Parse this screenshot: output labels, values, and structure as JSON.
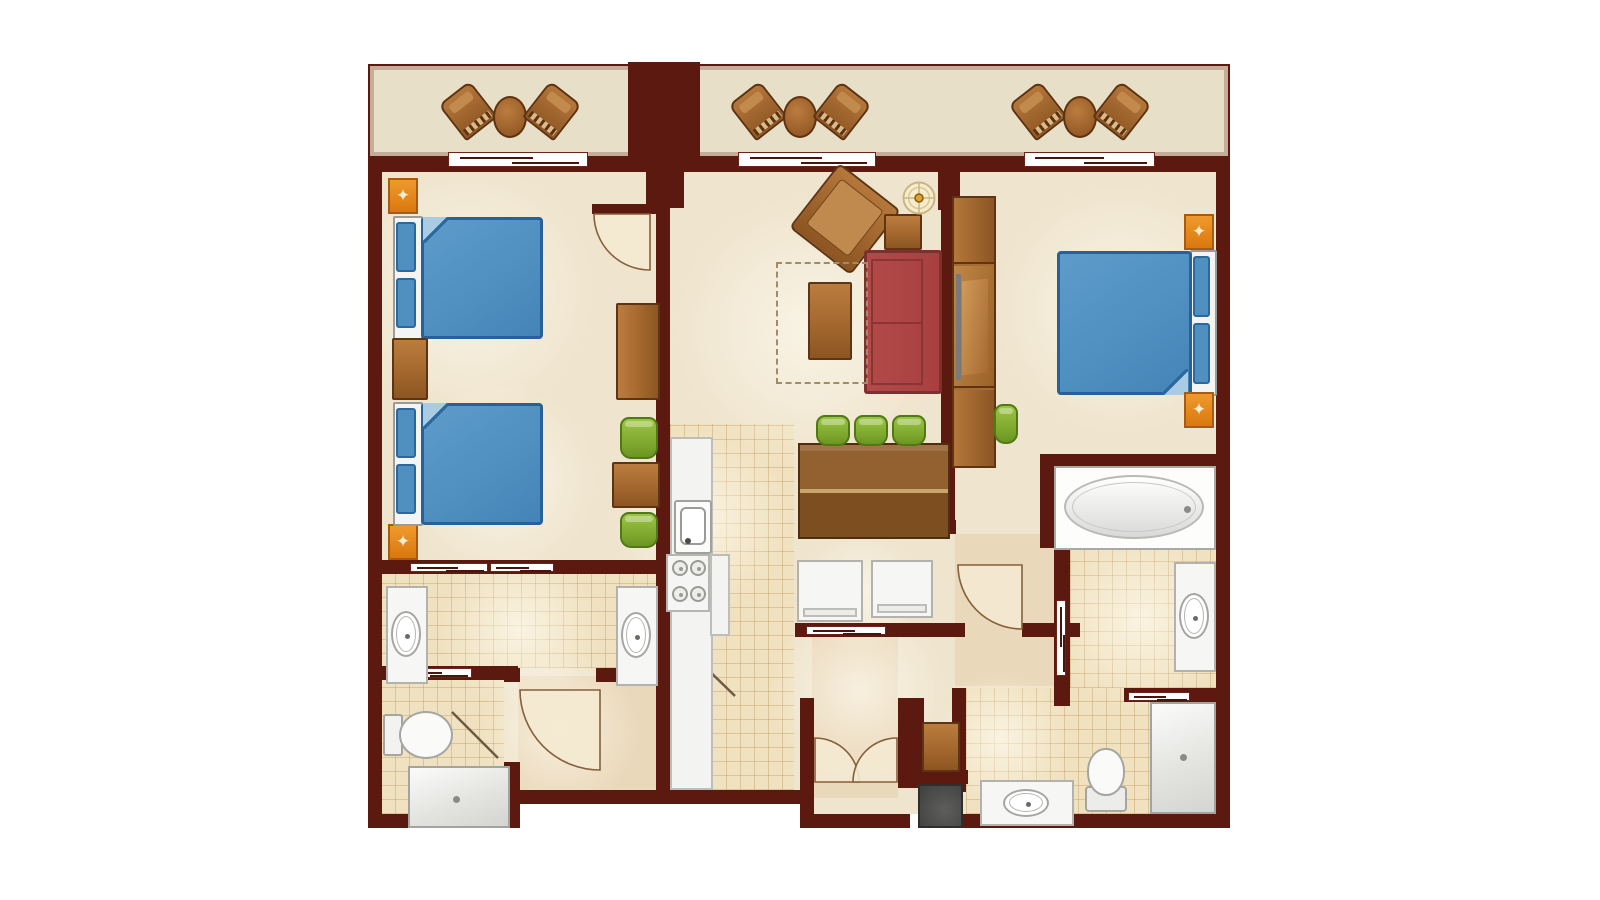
{
  "meta": {
    "description": "Two-bedroom villa resort floor plan, top-down view, no text labels",
    "canvas": {
      "w": 1600,
      "h": 900,
      "background": "#ffffff"
    }
  },
  "palette": {
    "wall": "#5b190f",
    "floor": "#efe4cd",
    "floor_tan": "#ead8ba",
    "tile": "#f0e2c1",
    "balcony": "#e8dfc9",
    "wood": "#a4682e",
    "wood_dark_border": "#5e3514",
    "green_chair": "#7ba62c",
    "sofa_red": "#b04848",
    "sofa_border": "#7e2f2f",
    "bed_blue": "#4f90c1",
    "bed_border": "#276198",
    "fixture_white": "#f6f6f4",
    "orange": "#e5861c",
    "utility_gray": "#4e4e4c",
    "arc_stroke": "#85603a",
    "arc_fill": "#f4ead2"
  },
  "floors": [
    {
      "k": "balcony",
      "n": "balcony-floor",
      "x": 368,
      "y": 64,
      "w": 862,
      "h": 94
    },
    {
      "k": "cream",
      "n": "main-floor-upper",
      "x": 381,
      "y": 172,
      "w": 835,
      "h": 390
    },
    {
      "k": "cream",
      "n": "main-floor-left",
      "x": 381,
      "y": 562,
      "w": 276,
      "h": 252
    },
    {
      "k": "cream",
      "n": "main-floor-kitchen",
      "x": 657,
      "y": 562,
      "w": 141,
      "h": 228
    },
    {
      "k": "cream",
      "n": "main-floor-right",
      "x": 795,
      "y": 562,
      "w": 421,
      "h": 252
    },
    {
      "k": "tan",
      "n": "closet-floor",
      "x": 518,
      "y": 676,
      "w": 138,
      "h": 116
    },
    {
      "k": "tan",
      "n": "entry-hall-floor",
      "x": 812,
      "y": 637,
      "w": 86,
      "h": 161
    },
    {
      "k": "tan",
      "n": "bedroom2-hall-floor",
      "x": 955,
      "y": 534,
      "w": 99,
      "h": 152
    },
    {
      "k": "tile",
      "n": "vanity-room-tile",
      "x": 381,
      "y": 574,
      "w": 275,
      "h": 94
    },
    {
      "k": "tile",
      "n": "toilet-room-tile",
      "x": 381,
      "y": 680,
      "w": 123,
      "h": 134
    },
    {
      "k": "tile",
      "n": "kitchen-tile",
      "x": 670,
      "y": 424,
      "w": 124,
      "h": 366
    },
    {
      "k": "tile",
      "n": "bath2-upper-tile",
      "x": 1070,
      "y": 548,
      "w": 146,
      "h": 140
    },
    {
      "k": "tile",
      "n": "bath2-lower-tile",
      "x": 966,
      "y": 688,
      "w": 250,
      "h": 126
    },
    {
      "k": "white",
      "n": "plan-cutout",
      "x": 518,
      "y": 804,
      "w": 288,
      "h": 26
    }
  ],
  "glows": [
    [
      470,
      290,
      130
    ],
    [
      500,
      480,
      100
    ],
    [
      810,
      330,
      140
    ],
    [
      700,
      520,
      90
    ],
    [
      860,
      690,
      90
    ],
    [
      1120,
      310,
      130
    ],
    [
      1140,
      620,
      90
    ],
    [
      520,
      630,
      80
    ],
    [
      560,
      730,
      80
    ],
    [
      860,
      590,
      60
    ],
    [
      1000,
      740,
      70
    ]
  ],
  "walls": [
    {
      "n": "wall-top",
      "x": 368,
      "y": 156,
      "w": 862,
      "h": 16
    },
    {
      "n": "wall-left",
      "x": 368,
      "y": 156,
      "w": 14,
      "h": 672
    },
    {
      "n": "wall-right",
      "x": 1216,
      "y": 156,
      "w": 14,
      "h": 672
    },
    {
      "n": "wall-bottom-left",
      "x": 368,
      "y": 814,
      "w": 152,
      "h": 14
    },
    {
      "n": "wall-step",
      "x": 504,
      "y": 762,
      "w": 16,
      "h": 66
    },
    {
      "n": "wall-bottom-mid",
      "x": 504,
      "y": 790,
      "w": 302,
      "h": 14
    },
    {
      "n": "wall-entry-left",
      "x": 800,
      "y": 698,
      "w": 14,
      "h": 130
    },
    {
      "n": "wall-entry-right",
      "x": 898,
      "y": 698,
      "w": 14,
      "h": 90
    },
    {
      "n": "wall-entry-bottom",
      "x": 806,
      "y": 814,
      "w": 104,
      "h": 14
    },
    {
      "n": "wall-utility-top",
      "x": 908,
      "y": 770,
      "w": 60,
      "h": 14
    },
    {
      "n": "wall-utility-left",
      "x": 908,
      "y": 698,
      "w": 16,
      "h": 90
    },
    {
      "n": "wall-bath2-divider",
      "x": 952,
      "y": 688,
      "w": 14,
      "h": 104
    },
    {
      "n": "wall-bottom-right",
      "x": 952,
      "y": 814,
      "w": 278,
      "h": 14
    },
    {
      "n": "wall-bed1-block",
      "x": 646,
      "y": 166,
      "w": 38,
      "h": 42
    },
    {
      "n": "wall-bed1-vertical",
      "x": 656,
      "y": 196,
      "w": 14,
      "h": 594
    },
    {
      "n": "wall-bed1-door",
      "x": 592,
      "y": 204,
      "w": 72,
      "h": 10
    },
    {
      "n": "wall-bed1-bottom",
      "x": 368,
      "y": 560,
      "w": 300,
      "h": 14
    },
    {
      "n": "wall-living-block",
      "x": 938,
      "y": 166,
      "w": 22,
      "h": 44
    },
    {
      "n": "wall-living-vertical",
      "x": 941,
      "y": 196,
      "w": 14,
      "h": 338
    },
    {
      "n": "wall-hall-h",
      "x": 912,
      "y": 520,
      "w": 44,
      "h": 14
    },
    {
      "n": "wall-laundry",
      "x": 795,
      "y": 623,
      "w": 170,
      "h": 14
    },
    {
      "n": "wall-bed2-bottom",
      "x": 1040,
      "y": 454,
      "w": 190,
      "h": 14
    },
    {
      "n": "wall-tub-left",
      "x": 1040,
      "y": 454,
      "w": 14,
      "h": 94
    },
    {
      "n": "wall-hall2-h",
      "x": 1022,
      "y": 623,
      "w": 58,
      "h": 14
    },
    {
      "n": "wall-hall2-v",
      "x": 1054,
      "y": 548,
      "w": 16,
      "h": 158
    },
    {
      "n": "wall-shower-top",
      "x": 1124,
      "y": 688,
      "w": 106,
      "h": 14
    },
    {
      "n": "wall-closet-top-a",
      "x": 504,
      "y": 668,
      "w": 16,
      "h": 14
    },
    {
      "n": "wall-closet-top-b",
      "x": 596,
      "y": 668,
      "w": 62,
      "h": 14
    },
    {
      "n": "wall-toilet-top",
      "x": 368,
      "y": 666,
      "w": 150,
      "h": 14
    },
    {
      "n": "balcony-column",
      "x": 628,
      "y": 62,
      "w": 72,
      "h": 96
    }
  ],
  "sliders": [
    {
      "n": "balcony-slider-1",
      "x": 448,
      "y": 152,
      "w": 140,
      "h": 15,
      "o": "h"
    },
    {
      "n": "balcony-slider-2",
      "x": 738,
      "y": 152,
      "w": 138,
      "h": 15,
      "o": "h"
    },
    {
      "n": "balcony-slider-3",
      "x": 1024,
      "y": 152,
      "w": 131,
      "h": 15,
      "o": "h"
    },
    {
      "n": "vanity-pocket-door-1",
      "x": 410,
      "y": 563,
      "w": 78,
      "h": 9,
      "o": "h"
    },
    {
      "n": "vanity-pocket-door-2",
      "x": 490,
      "y": 563,
      "w": 64,
      "h": 9,
      "o": "h"
    },
    {
      "n": "toilet-pocket-door",
      "x": 394,
      "y": 668,
      "w": 78,
      "h": 10,
      "o": "h"
    },
    {
      "n": "hall-pocket-door",
      "x": 806,
      "y": 626,
      "w": 80,
      "h": 9,
      "o": "h"
    },
    {
      "n": "bath2-pocket-door",
      "x": 1056,
      "y": 600,
      "w": 10,
      "h": 76,
      "o": "v"
    },
    {
      "n": "shower2-pocket-door",
      "x": 1128,
      "y": 692,
      "w": 62,
      "h": 9,
      "o": "h"
    }
  ],
  "arcs": [
    {
      "n": "bedroom1-door-swing",
      "d": "M594,214 A56,56 0 0 0 650,270 L650,214 Z"
    },
    {
      "n": "closet-door-swing",
      "d": "M520,690 A80,80 0 0 0 600,770 L600,690 Z"
    },
    {
      "n": "bedroom2-hall-door-swing",
      "d": "M958,565 A64,64 0 0 0 1022,629 L1022,565 Z"
    },
    {
      "n": "entry-door-left-swing",
      "d": "M859,782 A44,44 0 0 0 815,738 L815,782 Z"
    },
    {
      "n": "entry-door-right-swing",
      "d": "M853,782 A44,44 0 0 1 897,738 L897,782 Z"
    }
  ],
  "lines": [
    {
      "n": "toilet-room-door-leaf",
      "d": "M452,712 L498,758"
    },
    {
      "n": "kitchen-end-door-leaf",
      "d": "M700,662 L735,696"
    }
  ],
  "items": [
    {
      "t": "rocker",
      "n": "balcony-rocking-chair-1",
      "x": 448,
      "y": 88,
      "w": 40,
      "h": 46,
      "r": -38
    },
    {
      "t": "ovaltable",
      "n": "balcony-table-1",
      "x": 493,
      "y": 96,
      "w": 34,
      "h": 42
    },
    {
      "t": "rocker",
      "n": "balcony-rocking-chair-2",
      "x": 532,
      "y": 88,
      "w": 40,
      "h": 46,
      "r": 38
    },
    {
      "t": "rocker",
      "n": "balcony-rocking-chair-3",
      "x": 738,
      "y": 88,
      "w": 40,
      "h": 46,
      "r": -38
    },
    {
      "t": "ovaltable",
      "n": "balcony-table-2",
      "x": 783,
      "y": 96,
      "w": 34,
      "h": 42
    },
    {
      "t": "rocker",
      "n": "balcony-rocking-chair-4",
      "x": 822,
      "y": 88,
      "w": 40,
      "h": 46,
      "r": 38
    },
    {
      "t": "rocker",
      "n": "balcony-rocking-chair-5",
      "x": 1018,
      "y": 88,
      "w": 40,
      "h": 46,
      "r": -38
    },
    {
      "t": "ovaltable",
      "n": "balcony-table-3",
      "x": 1063,
      "y": 96,
      "w": 34,
      "h": 42
    },
    {
      "t": "rocker",
      "n": "balcony-rocking-chair-6",
      "x": 1102,
      "y": 88,
      "w": 40,
      "h": 46,
      "r": 38
    },
    {
      "t": "orange",
      "n": "bedroom1-lamp-table-top",
      "x": 388,
      "y": 178,
      "w": 30,
      "h": 36
    },
    {
      "t": "orange",
      "n": "bedroom1-lamp-table-bottom",
      "x": 388,
      "y": 524,
      "w": 30,
      "h": 36
    },
    {
      "t": "bed",
      "n": "bedroom1-queen-bed-1",
      "x": 393,
      "y": 216,
      "w": 152,
      "h": 124,
      "s": "l"
    },
    {
      "t": "wood",
      "n": "bedroom1-nightstand",
      "x": 392,
      "y": 338,
      "w": 36,
      "h": 62
    },
    {
      "t": "bed",
      "n": "bedroom1-queen-bed-2",
      "x": 393,
      "y": 402,
      "w": 152,
      "h": 124,
      "s": "l"
    },
    {
      "t": "woodv",
      "n": "bedroom1-tv-dresser",
      "x": 616,
      "y": 303,
      "w": 44,
      "h": 97
    },
    {
      "t": "gchair",
      "n": "cafe-chair-1",
      "x": 620,
      "y": 417,
      "w": 38,
      "h": 42
    },
    {
      "t": "wood",
      "n": "cafe-table",
      "x": 612,
      "y": 462,
      "w": 48,
      "h": 46
    },
    {
      "t": "gchair",
      "n": "cafe-chair-2",
      "x": 620,
      "y": 512,
      "w": 38,
      "h": 36
    },
    {
      "t": "armchair",
      "n": "living-armchair",
      "x": 806,
      "y": 178,
      "w": 78,
      "h": 82,
      "r": 38
    },
    {
      "t": "wood",
      "n": "living-side-table",
      "x": 884,
      "y": 214,
      "w": 38,
      "h": 36
    },
    {
      "t": "medallion",
      "n": "living-compass-table",
      "x": 902,
      "y": 181,
      "w": 34,
      "h": 34
    },
    {
      "t": "sofa",
      "n": "living-sleeper-sofa",
      "x": 864,
      "y": 250,
      "w": 78,
      "h": 144
    },
    {
      "t": "dashed",
      "n": "sofa-pullout-outline",
      "x": 776,
      "y": 262,
      "w": 92,
      "h": 122
    },
    {
      "t": "wood",
      "n": "living-coffee-table",
      "x": 808,
      "y": 282,
      "w": 44,
      "h": 78
    },
    {
      "t": "dining",
      "n": "dining-table",
      "x": 798,
      "y": 443,
      "w": 152,
      "h": 96
    },
    {
      "t": "gchair",
      "n": "dining-chair-1",
      "x": 816,
      "y": 415,
      "w": 34,
      "h": 31
    },
    {
      "t": "gchair",
      "n": "dining-chair-2",
      "x": 854,
      "y": 415,
      "w": 34,
      "h": 31
    },
    {
      "t": "gchair",
      "n": "dining-chair-3",
      "x": 892,
      "y": 415,
      "w": 34,
      "h": 31
    },
    {
      "t": "appliance",
      "n": "washer",
      "x": 797,
      "y": 560,
      "w": 66,
      "h": 62
    },
    {
      "t": "appliance",
      "n": "dryer",
      "x": 871,
      "y": 560,
      "w": 62,
      "h": 58
    },
    {
      "t": "island",
      "n": "kitchen-counter",
      "x": 670,
      "y": 437,
      "w": 43,
      "h": 353
    },
    {
      "t": "sinkk",
      "n": "kitchen-sink",
      "x": 674,
      "y": 500,
      "w": 38,
      "h": 54
    },
    {
      "t": "stove",
      "n": "kitchen-stove",
      "x": 666,
      "y": 554,
      "w": 44,
      "h": 58
    },
    {
      "t": "island",
      "n": "kitchen-counter-wing",
      "x": 710,
      "y": 554,
      "w": 20,
      "h": 82
    },
    {
      "t": "wardrobe",
      "n": "bedroom2-wardrobe-desk",
      "x": 952,
      "y": 196,
      "w": 44,
      "h": 272
    },
    {
      "t": "stool",
      "n": "bedroom2-desk-stool",
      "x": 994,
      "y": 404,
      "w": 24,
      "h": 40
    },
    {
      "t": "bed",
      "n": "bedroom2-king-bed",
      "x": 1055,
      "y": 250,
      "w": 162,
      "h": 146,
      "s": "r"
    },
    {
      "t": "orange",
      "n": "bedroom2-nightstand-top",
      "x": 1184,
      "y": 214,
      "w": 30,
      "h": 36
    },
    {
      "t": "orange",
      "n": "bedroom2-nightstand-bottom",
      "x": 1184,
      "y": 392,
      "w": 30,
      "h": 36
    },
    {
      "t": "tub",
      "n": "bath2-soaking-tub",
      "x": 1054,
      "y": 466,
      "w": 162,
      "h": 84
    },
    {
      "t": "vanv",
      "n": "bath2-vanity-upper",
      "x": 1174,
      "y": 562,
      "w": 42,
      "h": 110
    },
    {
      "t": "vanv",
      "n": "bath1-vanity-left",
      "x": 386,
      "y": 586,
      "w": 42,
      "h": 98
    },
    {
      "t": "vanv",
      "n": "bath1-vanity-right",
      "x": 616,
      "y": 586,
      "w": 42,
      "h": 100
    },
    {
      "t": "vanh",
      "n": "bath2-vanity-lower",
      "x": 980,
      "y": 780,
      "w": 94,
      "h": 46
    },
    {
      "t": "toir",
      "n": "bath1-toilet",
      "x": 383,
      "y": 710,
      "w": 72,
      "h": 50
    },
    {
      "t": "toiu",
      "n": "bath2-toilet",
      "x": 1084,
      "y": 748,
      "w": 46,
      "h": 66
    },
    {
      "t": "shower",
      "n": "bath1-shower",
      "x": 408,
      "y": 766,
      "w": 102,
      "h": 62
    },
    {
      "t": "shower",
      "n": "bath2-shower",
      "x": 1150,
      "y": 702,
      "w": 66,
      "h": 112
    },
    {
      "t": "util",
      "n": "utility-closet",
      "x": 918,
      "y": 784,
      "w": 45,
      "h": 44
    },
    {
      "t": "wood",
      "n": "entry-cabinet",
      "x": 922,
      "y": 722,
      "w": 38,
      "h": 50
    }
  ]
}
